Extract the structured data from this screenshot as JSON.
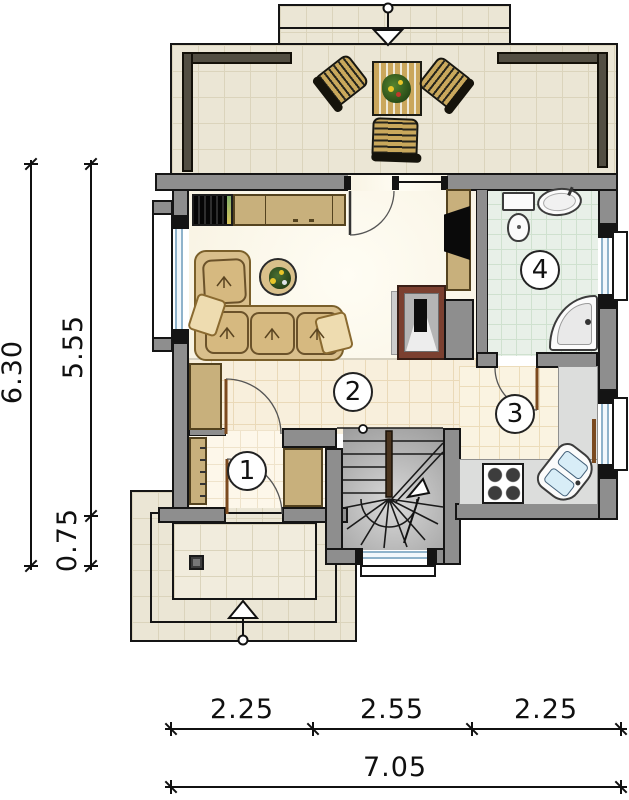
{
  "title": "house ground-floor plan",
  "rooms": {
    "r1": "1",
    "r2": "2",
    "r3": "3",
    "r4": "4"
  },
  "dims": {
    "v_total": "6.30",
    "v_main": "5.55",
    "v_porch": "0.75",
    "h_left": "2.25",
    "h_mid": "2.55",
    "h_right": "2.25",
    "h_total": "7.05"
  },
  "colors": {
    "wall_grey": "#8e8e8e",
    "outline_black": "#151515",
    "railing_dark": "#524e42",
    "furniture_tan": "#c8b07c",
    "fireplace_maroon": "#7b4030",
    "bath_tile_mint": "#e8f0e8",
    "hall_tile_ecru": "#f8efdc",
    "terrace_tile": "#ebe6d5",
    "window_blue": "#8fb3cb",
    "counter_grey": "#dcdddc",
    "door_wood_brown": "#7c4a1e"
  },
  "fixtures": [
    "terrace-table",
    "wicker-chair",
    "corner-sofa",
    "coffee-table-plant",
    "bookshelf",
    "sideboard",
    "tv",
    "fireplace",
    "wardrobe",
    "coat-rack",
    "winder-stairs",
    "gas-stove",
    "kitchen-sink",
    "toilet",
    "washbasin",
    "corner-bathtub",
    "porch-column"
  ],
  "arrows": [
    "terrace-entrance-arrow",
    "main-entrance-arrow",
    "stairs-up-arrow"
  ]
}
